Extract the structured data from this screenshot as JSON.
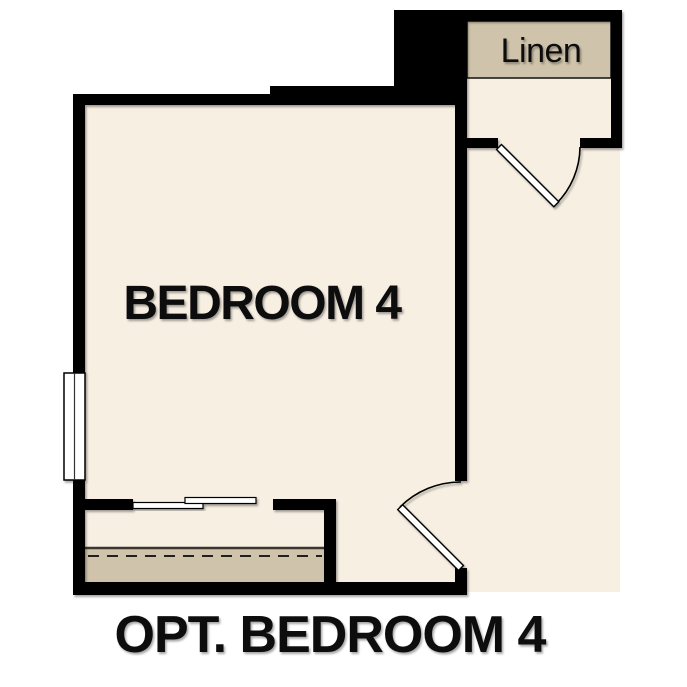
{
  "colors": {
    "wall": "#000000",
    "floor": "#f7efe2",
    "shelf": "#cfc3ab",
    "door": "#ffffff",
    "text": "#111111",
    "background": "#ffffff"
  },
  "floor_plan": {
    "caption": "OPT. BEDROOM 4",
    "rooms": {
      "bedroom": {
        "label": "BEDROOM 4"
      },
      "linen": {
        "label": "Linen"
      }
    },
    "symbols": {
      "window": "double-line-window",
      "bypass_doors": "sliding-bypass-closet-doors",
      "linen_door": "swing-door",
      "bedroom_door": "swing-door",
      "closet_rod": "dashed-rod-line",
      "closet_shelf": "shelf-band"
    }
  }
}
